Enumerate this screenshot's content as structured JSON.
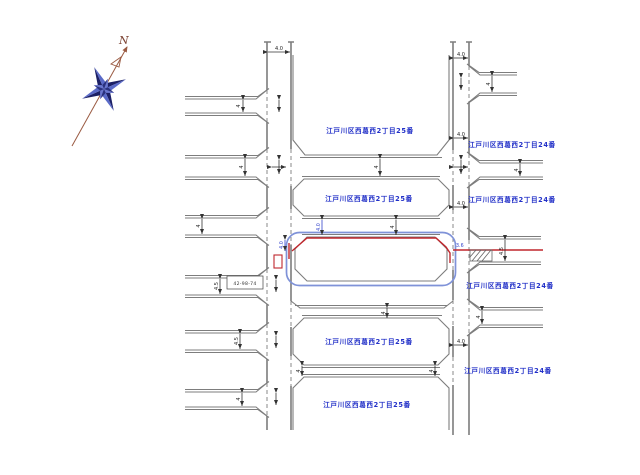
{
  "drawing": {
    "type": "cadastral-road-map",
    "compass": {
      "north_label": "N"
    },
    "colors": {
      "label_blue": "#2230c8",
      "parcel_blue": "#7f92d8",
      "highlight_red": "#c0272d",
      "road_gray": "#7d7d7d",
      "dim_black": "#222222",
      "compass_dark": "#1c2066",
      "compass_light": "#5a6ac8",
      "compass_needle": "#9a5a42"
    },
    "block_labels": [
      {
        "text": "江戸川区西葛西2丁目25番"
      },
      {
        "text": "江戸川区西葛西2丁目25番"
      },
      {
        "text": "江戸川区西葛西2丁目25番"
      },
      {
        "text": "江戸川区西葛西2丁目25番"
      },
      {
        "text": "江戸川区西葛西2丁目24番"
      },
      {
        "text": "江戸川区西葛西2丁目24番"
      },
      {
        "text": "江戸川区西葛西2丁目24番"
      },
      {
        "text": "江戸川区西葛西2丁目24番"
      }
    ],
    "dims": [
      "4",
      "4",
      "4",
      "4.5",
      "4.5",
      "4",
      "4",
      "4",
      "4",
      "4",
      "4",
      "4.0",
      "4.0",
      "4.0",
      "4.0",
      "4.0",
      "4",
      "4",
      "4.5",
      "4",
      "4.0",
      "4.0",
      "3.6"
    ],
    "annotation_box": {
      "text": "42-98-74"
    }
  }
}
